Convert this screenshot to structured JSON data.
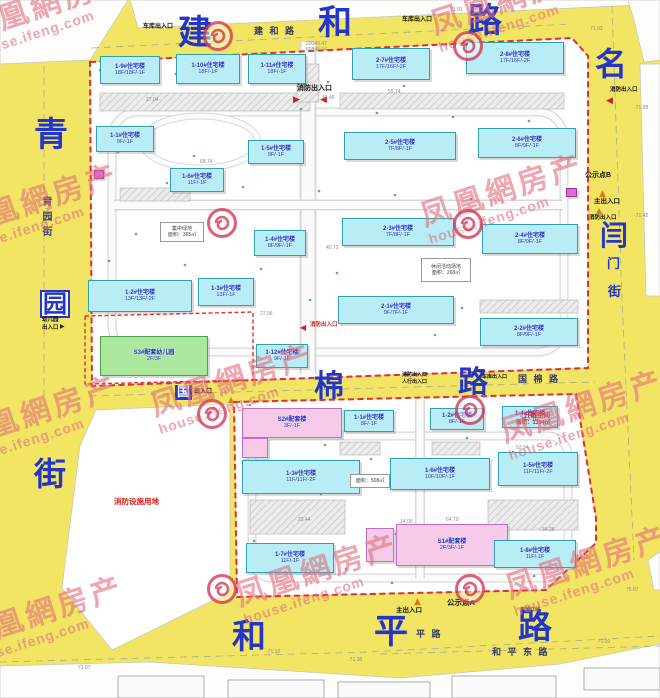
{
  "watermark": {
    "line1": "凤凰網房产",
    "line2": "house.ifeng.com"
  },
  "watermark_positions": [
    {
      "x": -35,
      "y": -10
    },
    {
      "x": 430,
      "y": -16
    },
    {
      "x": -45,
      "y": 186
    },
    {
      "x": 420,
      "y": 176
    },
    {
      "x": 150,
      "y": 366
    },
    {
      "x": -45,
      "y": 398
    },
    {
      "x": 500,
      "y": 392
    },
    {
      "x": -40,
      "y": 598
    },
    {
      "x": 235,
      "y": 556
    },
    {
      "x": 505,
      "y": 548
    }
  ],
  "logo_positions": [
    {
      "x": 218,
      "y": 36
    },
    {
      "x": 468,
      "y": 46
    },
    {
      "x": 222,
      "y": 223
    },
    {
      "x": 468,
      "y": 224
    },
    {
      "x": 212,
      "y": 414
    },
    {
      "x": 470,
      "y": 410
    },
    {
      "x": 222,
      "y": 589
    },
    {
      "x": 470,
      "y": 589
    }
  ],
  "road_big_labels": [
    {
      "t": "建",
      "x": 178,
      "y": 16,
      "fs": 34,
      "box": "none"
    },
    {
      "t": "和",
      "x": 318,
      "y": 6,
      "fs": 34,
      "box": "none"
    },
    {
      "t": "路",
      "x": 468,
      "y": 4,
      "fs": 34,
      "box": "none"
    },
    {
      "t": "名",
      "x": 595,
      "y": 48,
      "fs": 32,
      "box": "none"
    },
    {
      "t": "青",
      "x": 34,
      "y": 118,
      "fs": 34,
      "box": "none"
    },
    {
      "t": "园",
      "x": 40,
      "y": 290,
      "fs": 24,
      "box": "outline"
    },
    {
      "t": "街",
      "x": 34,
      "y": 458,
      "fs": 32,
      "box": "none"
    },
    {
      "t": "国",
      "x": 175,
      "y": 385,
      "fs": 13,
      "box": "solid"
    },
    {
      "t": "棉",
      "x": 314,
      "y": 372,
      "fs": 30,
      "box": "none"
    },
    {
      "t": "路",
      "x": 458,
      "y": 368,
      "fs": 30,
      "box": "none"
    },
    {
      "t": "闫",
      "x": 600,
      "y": 222,
      "fs": 28,
      "box": "none"
    },
    {
      "t": "门",
      "x": 607,
      "y": 258,
      "fs": 13,
      "box": "none"
    },
    {
      "t": "街",
      "x": 608,
      "y": 286,
      "fs": 13,
      "box": "none"
    },
    {
      "t": "和",
      "x": 232,
      "y": 620,
      "fs": 34,
      "box": "none"
    },
    {
      "t": "平",
      "x": 374,
      "y": 615,
      "fs": 34,
      "box": "none"
    },
    {
      "t": "路",
      "x": 518,
      "y": 610,
      "fs": 34,
      "box": "none"
    }
  ],
  "road_small_labels": [
    {
      "t": "建 和 路",
      "x": 254,
      "y": 24,
      "fs": 9
    },
    {
      "t": "国 棉 路",
      "x": 518,
      "y": 372,
      "fs": 9
    },
    {
      "t": "平 路",
      "x": 416,
      "y": 627,
      "fs": 9
    },
    {
      "t": "和 平 东 路",
      "x": 492,
      "y": 645,
      "fs": 9
    }
  ],
  "vertical_street": {
    "t": "青园街",
    "x": 38,
    "y": 196
  },
  "entrance_labels": [
    {
      "t": "车库出入口",
      "x": 143,
      "y": 24,
      "fs": 6,
      "c": "#111111"
    },
    {
      "t": "车库出入口",
      "x": 402,
      "y": 17,
      "fs": 6,
      "c": "#111111"
    },
    {
      "t": "消防出入口",
      "x": 297,
      "y": 85,
      "fs": 7,
      "c": "#111111"
    },
    {
      "t": "消防出入口",
      "x": 610,
      "y": 87,
      "fs": 5.5,
      "c": "#111111"
    },
    {
      "t": "消防出入口",
      "x": 310,
      "y": 322,
      "fs": 5.5,
      "c": "#d02020"
    },
    {
      "t": "公示点B",
      "x": 585,
      "y": 172,
      "fs": 7,
      "c": "#111111"
    },
    {
      "t": "主出入口",
      "x": 594,
      "y": 198,
      "fs": 6.5,
      "c": "#111111"
    },
    {
      "t": "消防出入口",
      "x": 589,
      "y": 215,
      "fs": 5.5,
      "c": "#111111"
    },
    {
      "t": "公示点A",
      "x": 447,
      "y": 599,
      "fs": 7.5,
      "c": "#111111"
    },
    {
      "t": "主出入口",
      "x": 396,
      "y": 607,
      "fs": 6.5,
      "c": "#111111"
    },
    {
      "t": "用地红线",
      "x": 520,
      "y": 608,
      "fs": 5,
      "c": "#555555"
    },
    {
      "t": "幼儿园",
      "x": 42,
      "y": 317,
      "fs": 5.5,
      "c": "#111111"
    },
    {
      "t": "出入口",
      "x": 42,
      "y": 325,
      "fs": 5.5,
      "c": "#111111"
    },
    {
      "t": "出入口",
      "x": 194,
      "y": 389,
      "fs": 6,
      "c": "#111111"
    },
    {
      "t": "消防出入口",
      "x": 402,
      "y": 373,
      "fs": 5,
      "c": "#111111"
    },
    {
      "t": "人行出入口",
      "x": 402,
      "y": 380,
      "fs": 5,
      "c": "#111111"
    },
    {
      "t": "车库出入口",
      "x": 482,
      "y": 375,
      "fs": 5,
      "c": "#111111"
    },
    {
      "t": "消防设施用地",
      "x": 114,
      "y": 498,
      "fs": 7.5,
      "c": "#d42020"
    },
    {
      "t": "开敞空间",
      "x": 524,
      "y": 412,
      "fs": 6.5,
      "c": "#d42020"
    },
    {
      "t": "面积：1304㎡",
      "x": 516,
      "y": 420,
      "fs": 5.5,
      "c": "#d42020"
    }
  ],
  "markers": [
    {
      "g": "▶",
      "x": 293,
      "y": 96,
      "c": "#d42020",
      "s": 9
    },
    {
      "g": "◀",
      "x": 320,
      "y": 96,
      "c": "#d42020",
      "s": 9
    },
    {
      "g": "◀",
      "x": 606,
      "y": 97,
      "c": "#d42020",
      "s": 9
    },
    {
      "g": "◀",
      "x": 300,
      "y": 324,
      "c": "#d42020",
      "s": 8
    },
    {
      "g": "▲",
      "x": 599,
      "y": 190,
      "c": "#e07818",
      "s": 9
    },
    {
      "g": "▲",
      "x": 596,
      "y": 207,
      "c": "#e07818",
      "s": 8
    },
    {
      "g": "▲",
      "x": 414,
      "y": 598,
      "c": "#e07818",
      "s": 9
    },
    {
      "g": "▲",
      "x": 228,
      "y": 396,
      "c": "#e07818",
      "s": 8
    },
    {
      "g": "▶",
      "x": 60,
      "y": 324,
      "c": "#222222",
      "s": 6
    }
  ],
  "buildings": [
    {
      "name": "1-9#住宅楼",
      "floors": "18F/18F/-1F",
      "x": 100,
      "y": 56,
      "w": 60,
      "h": 28,
      "type": "res"
    },
    {
      "name": "1-10#住宅楼",
      "floors": "18F/-1F",
      "x": 176,
      "y": 54,
      "w": 64,
      "h": 30,
      "type": "res"
    },
    {
      "name": "1-11#住宅楼",
      "floors": "18F/-1F",
      "x": 248,
      "y": 54,
      "w": 58,
      "h": 30,
      "type": "res"
    },
    {
      "name": "2-7#住宅楼",
      "floors": "17F/16F/-2F",
      "x": 352,
      "y": 48,
      "w": 78,
      "h": 32,
      "type": "res"
    },
    {
      "name": "2-8#住宅楼",
      "floors": "17F/16F/-2F",
      "x": 466,
      "y": 42,
      "w": 98,
      "h": 32,
      "type": "res"
    },
    {
      "name": "1-1#住宅楼",
      "floors": "9F/-1F",
      "x": 96,
      "y": 126,
      "w": 58,
      "h": 26,
      "type": "res"
    },
    {
      "name": "1-5#住宅楼",
      "floors": "9F/-1F",
      "x": 248,
      "y": 140,
      "w": 56,
      "h": 24,
      "type": "res"
    },
    {
      "name": "1-6#住宅楼",
      "floors": "11F/-1F",
      "x": 170,
      "y": 168,
      "w": 54,
      "h": 24,
      "type": "res"
    },
    {
      "name": "2-5#住宅楼",
      "floors": "7F/8F/-1F",
      "x": 344,
      "y": 132,
      "w": 112,
      "h": 28,
      "type": "res"
    },
    {
      "name": "2-6#住宅楼",
      "floors": "8F/9F/-1F",
      "x": 478,
      "y": 128,
      "w": 98,
      "h": 30,
      "type": "res"
    },
    {
      "name": "1-4#住宅楼",
      "floors": "8F/9F/-1F",
      "x": 254,
      "y": 230,
      "w": 52,
      "h": 26,
      "type": "res"
    },
    {
      "name": "1-2#住宅楼",
      "floors": "13F/13F/-2F",
      "x": 88,
      "y": 280,
      "w": 104,
      "h": 32,
      "type": "res"
    },
    {
      "name": "1-3#住宅楼",
      "floors": "13F/-1F",
      "x": 198,
      "y": 278,
      "w": 56,
      "h": 28,
      "type": "res"
    },
    {
      "name": "2-3#住宅楼",
      "floors": "7F/8F/-1F",
      "x": 342,
      "y": 218,
      "w": 112,
      "h": 28,
      "type": "res"
    },
    {
      "name": "2-4#住宅楼",
      "floors": "8F/9F/-1F",
      "x": 482,
      "y": 224,
      "w": 96,
      "h": 30,
      "type": "res"
    },
    {
      "name": "2-1#住宅楼",
      "floors": "9F/7F/-1F",
      "x": 338,
      "y": 296,
      "w": 116,
      "h": 28,
      "type": "res"
    },
    {
      "name": "2-2#住宅楼",
      "floors": "8F/9F/-1F",
      "x": 480,
      "y": 318,
      "w": 98,
      "h": 28,
      "type": "res"
    },
    {
      "name": "S3#配套幼儿园",
      "floors": "2F/3F",
      "x": 100,
      "y": 336,
      "w": 108,
      "h": 40,
      "type": "kinder"
    },
    {
      "name": "1-12#住宅楼",
      "floors": "9F/-1F",
      "x": 256,
      "y": 344,
      "w": 52,
      "h": 24,
      "type": "res"
    },
    {
      "name": "S2#配套楼",
      "floors": "3F/-1F",
      "x": 242,
      "y": 408,
      "w": 100,
      "h": 30,
      "type": "service"
    },
    {
      "name": "",
      "floors": "",
      "x": 242,
      "y": 438,
      "w": 26,
      "h": 20,
      "type": "service"
    },
    {
      "name": "1-1#住宅楼",
      "floors": "8F/-1F",
      "x": 344,
      "y": 410,
      "w": 50,
      "h": 22,
      "type": "res"
    },
    {
      "name": "1-2#住宅楼",
      "floors": "8F/-1F",
      "x": 430,
      "y": 408,
      "w": 54,
      "h": 22,
      "type": "res"
    },
    {
      "name": "1-4#住宅楼",
      "floors": "8F/-1F",
      "x": 502,
      "y": 406,
      "w": 56,
      "h": 22,
      "type": "res"
    },
    {
      "name": "1-3#住宅楼",
      "floors": "11F/11F/-2F",
      "x": 242,
      "y": 460,
      "w": 118,
      "h": 34,
      "type": "res"
    },
    {
      "name": "1-6#住宅楼",
      "floors": "10F/10F/-1F",
      "x": 390,
      "y": 458,
      "w": 100,
      "h": 32,
      "type": "res"
    },
    {
      "name": "1-5#住宅楼",
      "floors": "11F/11F/-2F",
      "x": 498,
      "y": 452,
      "w": 80,
      "h": 34,
      "type": "res"
    },
    {
      "name": "S1#配套楼",
      "floors": "2F/3F/-1F",
      "x": 396,
      "y": 524,
      "w": 112,
      "h": 42,
      "type": "service"
    },
    {
      "name": "",
      "floors": "",
      "x": 366,
      "y": 528,
      "w": 28,
      "h": 34,
      "type": "service"
    },
    {
      "name": "1-7#住宅楼",
      "floors": "11F/-1F",
      "x": 246,
      "y": 543,
      "w": 88,
      "h": 30,
      "type": "res"
    },
    {
      "name": "1-8#住宅楼",
      "floors": "11F/-1F",
      "x": 494,
      "y": 540,
      "w": 82,
      "h": 28,
      "type": "res"
    },
    {
      "name": "",
      "floors": "",
      "x": 94,
      "y": 170,
      "w": 10,
      "h": 9,
      "type": "utility"
    },
    {
      "name": "",
      "floors": "",
      "x": 566,
      "y": 188,
      "w": 11,
      "h": 9,
      "type": "utility"
    }
  ],
  "area_boxes": [
    {
      "lines": [
        "休闲活动场地",
        "面积：268㎡"
      ],
      "x": 421,
      "y": 258,
      "w": 48,
      "h": 22
    },
    {
      "lines": [
        "集中绿地",
        "面积：365㎡"
      ],
      "x": 160,
      "y": 222,
      "w": 42,
      "h": 18
    },
    {
      "lines": [
        "面积：508㎡"
      ],
      "x": 350,
      "y": 474,
      "w": 38,
      "h": 12
    }
  ],
  "dims": [
    {
      "t": "27.04",
      "x": 146,
      "y": 98
    },
    {
      "t": "55.74",
      "x": 388,
      "y": 90
    },
    {
      "t": "13.46",
      "x": 322,
      "y": 96
    },
    {
      "t": "68.74",
      "x": 200,
      "y": 160
    },
    {
      "t": "40.73",
      "x": 326,
      "y": 246
    },
    {
      "t": "27.96",
      "x": 260,
      "y": 312
    },
    {
      "t": "52.94",
      "x": 516,
      "y": 446
    },
    {
      "t": "64.79",
      "x": 446,
      "y": 518
    },
    {
      "t": "23.44",
      "x": 298,
      "y": 518
    },
    {
      "t": "14.09",
      "x": 400,
      "y": 520
    },
    {
      "t": "17.12",
      "x": 576,
      "y": 556
    },
    {
      "t": "34.28",
      "x": 542,
      "y": 528
    },
    {
      "t": "71.91",
      "x": 450,
      "y": 8
    },
    {
      "t": "71.03",
      "x": 590,
      "y": 27
    },
    {
      "t": "·71.08",
      "x": 634,
      "y": 106
    },
    {
      "t": "·71.42",
      "x": 634,
      "y": 214
    },
    {
      "t": "·71.12",
      "x": 266,
      "y": 650
    },
    {
      "t": "·71.38",
      "x": 348,
      "y": 658
    },
    {
      "t": "71.07",
      "x": 78,
      "y": 666
    },
    {
      "t": "75.87",
      "x": 626,
      "y": 588
    },
    {
      "t": "·71.09",
      "x": 596,
      "y": 640
    },
    {
      "t": "20040.47",
      "x": 306,
      "y": 42
    },
    {
      "t": "60845.44",
      "x": 306,
      "y": 48
    }
  ]
}
